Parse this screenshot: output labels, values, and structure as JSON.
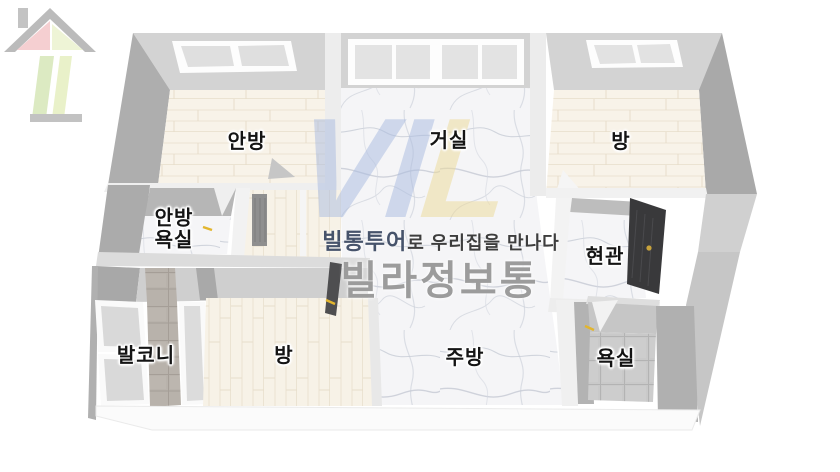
{
  "rooms": {
    "anbang": "안방",
    "geosil": "거실",
    "bang_top": "방",
    "anbang_yoksil": "안방욕실",
    "hyeongwan": "현관",
    "balkoni": "발코니",
    "bang_bottom": "방",
    "jubang": "주방",
    "yoksil": "욕실"
  },
  "watermark": {
    "logo_part1": "VI",
    "logo_part2": "L",
    "tagline_brand": "빌통투어",
    "tagline_rest": "로 우리집을 만나다",
    "brand": "빌라정보통"
  },
  "colors": {
    "wall_light": "#d3d3d3",
    "wall_dark": "#aaaaaa",
    "floor_wood": "#f8f3e9",
    "floor_marble": "#f5f5f7",
    "floor_tile_gray": "#c9c9c9",
    "floor_tile_warm": "#b8b2ab",
    "front_door_dark": "#39393b",
    "door_handle_gold": "#c8a33c",
    "accent_yellow": "#e2b52e",
    "logo_blue": "#a9bbe0",
    "logo_yellow": "#edda97",
    "house_pink": "#f0b0b4",
    "house_green": "#c6dd9a",
    "tagline_blue": "#46536b",
    "brand_gray": "#9c9c9c"
  }
}
